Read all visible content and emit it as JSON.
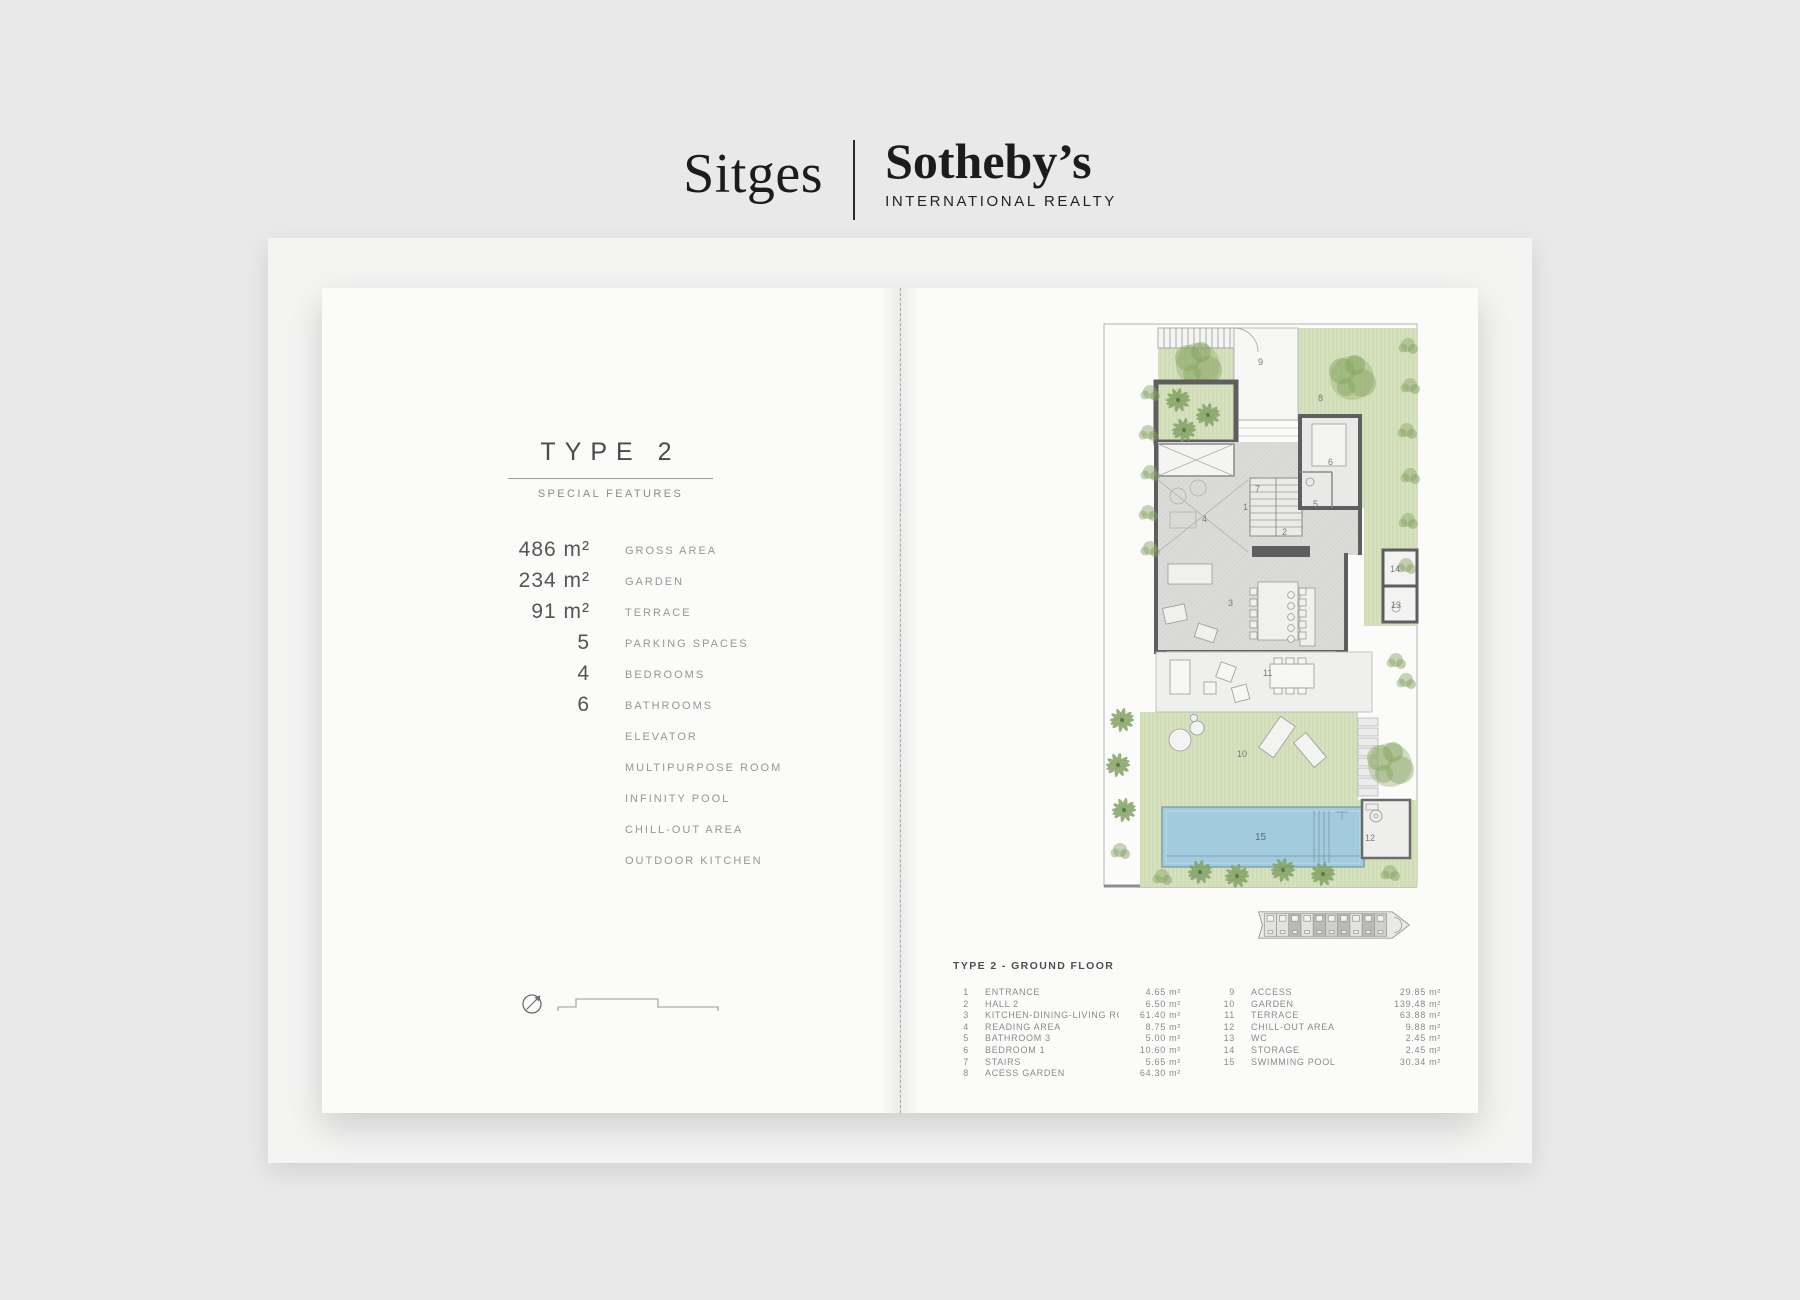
{
  "brand": {
    "city": "Sitges",
    "name": "Sotheby’s",
    "tagline": "INTERNATIONAL REALTY"
  },
  "left_page": {
    "title": "TYPE 2",
    "subtitle": "SPECIAL FEATURES",
    "features": [
      {
        "value": "486 m²",
        "label": "GROSS AREA"
      },
      {
        "value": "234 m²",
        "label": "GARDEN"
      },
      {
        "value": "91 m²",
        "label": "TERRACE"
      },
      {
        "value": "5",
        "label": "PARKING SPACES"
      },
      {
        "value": "4",
        "label": "BEDROOMS"
      },
      {
        "value": "6",
        "label": "BATHROOMS"
      },
      {
        "value": "",
        "label": "ELEVATOR"
      },
      {
        "value": "",
        "label": "MULTIPURPOSE ROOM"
      },
      {
        "value": "",
        "label": "INFINITY POOL"
      },
      {
        "value": "",
        "label": "CHILL-OUT AREA"
      },
      {
        "value": "",
        "label": "OUTDOOR KITCHEN"
      }
    ]
  },
  "legend": {
    "title": "TYPE 2 - GROUND FLOOR",
    "col1": [
      {
        "num": "1",
        "name": "ENTRANCE",
        "area": "4.65 m²"
      },
      {
        "num": "2",
        "name": "HALL 2",
        "area": "6.50 m²"
      },
      {
        "num": "3",
        "name": "KITCHEN-DINING-LIVING ROOM",
        "area": "61.40 m²"
      },
      {
        "num": "4",
        "name": "READING AREA",
        "area": "8.75 m²"
      },
      {
        "num": "5",
        "name": "BATHROOM 3",
        "area": "5.00 m²"
      },
      {
        "num": "6",
        "name": "BEDROOM 1",
        "area": "10.60 m²"
      },
      {
        "num": "7",
        "name": "STAIRS",
        "area": "5.65 m²"
      },
      {
        "num": "8",
        "name": "ACESS GARDEN",
        "area": "64.30 m²"
      }
    ],
    "col2": [
      {
        "num": "9",
        "name": "ACCESS",
        "area": "29.85 m²"
      },
      {
        "num": "10",
        "name": "GARDEN",
        "area": "139.48 m²"
      },
      {
        "num": "11",
        "name": "TERRACE",
        "area": "63.88 m²"
      },
      {
        "num": "12",
        "name": "CHILL-OUT AREA",
        "area": "9.88 m²"
      },
      {
        "num": "13",
        "name": "WC",
        "area": "2.45 m²"
      },
      {
        "num": "14",
        "name": "STORAGE",
        "area": "2.45 m²"
      },
      {
        "num": "15",
        "name": "SWIMMING POOL",
        "area": "30.34 m²"
      }
    ]
  },
  "plan": {
    "room_labels": [
      "1",
      "2",
      "3",
      "4",
      "5",
      "6",
      "7",
      "8",
      "9",
      "10",
      "11",
      "12",
      "13",
      "14",
      "15"
    ]
  },
  "colors": {
    "garden_green": "#d6e1bd",
    "pool_blue": "#a3cbde",
    "wall_gray": "#5e5e5e",
    "page_white": "#fbfbfa",
    "backdrop_gray": "#e9e9e9"
  }
}
